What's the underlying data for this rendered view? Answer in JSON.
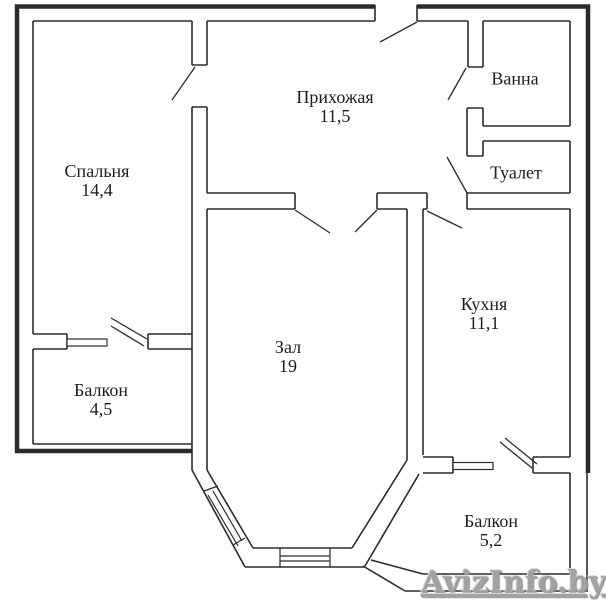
{
  "page": {
    "background": "#ffffff",
    "wall_color": "#2b2b2b"
  },
  "rooms": [
    {
      "name": "Спальня",
      "area": "14,4"
    },
    {
      "name": "Прихожая",
      "area": "11,5"
    },
    {
      "name": "Ванна",
      "area": ""
    },
    {
      "name": "Туалет",
      "area": ""
    },
    {
      "name": "Кухня",
      "area": "11,1"
    },
    {
      "name": "Зал",
      "area": "19"
    },
    {
      "name": "Балкон",
      "area": "4,5"
    },
    {
      "name": "Балкон",
      "area": "5,2"
    }
  ],
  "watermark": {
    "text": "AvizInfo.by",
    "color": "#a2a2a2"
  }
}
